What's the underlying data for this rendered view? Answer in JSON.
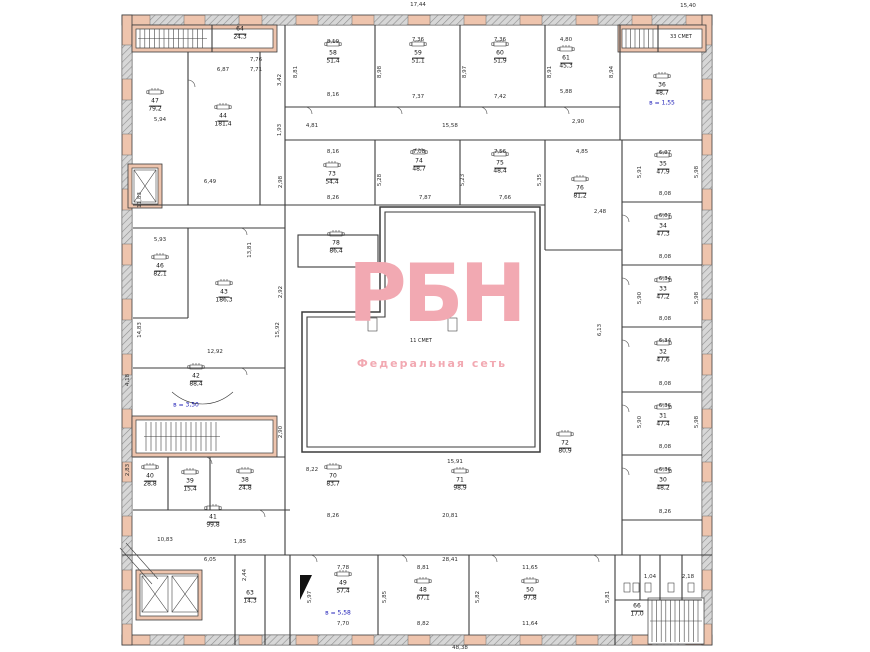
{
  "watermark": {
    "logo": "РБН",
    "tagline": "Федеральная сеть"
  },
  "colors": {
    "wall_fill": "#eec4ad",
    "window_fill": "#d7d7d7",
    "watermark_pink": "#f2a9b2",
    "blue_note": "#2222b8",
    "line": "#3b3b3b"
  },
  "rooms": [
    {
      "n": "64",
      "a": "24,3",
      "x": 240,
      "y": 34,
      "d": 0
    },
    {
      "n": "58",
      "a": "51,4",
      "x": 333,
      "y": 58,
      "d": 1
    },
    {
      "n": "59",
      "a": "51,1",
      "x": 418,
      "y": 58,
      "d": 1
    },
    {
      "n": "60",
      "a": "51,9",
      "x": 500,
      "y": 58,
      "d": 1
    },
    {
      "n": "61",
      "a": "45,3",
      "x": 566,
      "y": 63,
      "d": 1
    },
    {
      "n": "36",
      "a": "48,7",
      "x": 662,
      "y": 90,
      "d": 1
    },
    {
      "n": "47",
      "a": "79,2",
      "x": 155,
      "y": 106,
      "d": 1
    },
    {
      "n": "44",
      "a": "181,4",
      "x": 223,
      "y": 121,
      "d": 1
    },
    {
      "n": "73",
      "a": "54,4",
      "x": 332,
      "y": 179,
      "d": 1
    },
    {
      "n": "74",
      "a": "48,7",
      "x": 419,
      "y": 166,
      "d": 1
    },
    {
      "n": "75",
      "a": "48,4",
      "x": 500,
      "y": 168,
      "d": 1
    },
    {
      "n": "76",
      "a": "81,2",
      "x": 580,
      "y": 193,
      "d": 1
    },
    {
      "n": "78",
      "a": "86,4",
      "x": 336,
      "y": 248,
      "d": 1
    },
    {
      "n": "35",
      "a": "47,9",
      "x": 663,
      "y": 169,
      "d": 1
    },
    {
      "n": "34",
      "a": "47,3",
      "x": 663,
      "y": 231,
      "d": 1
    },
    {
      "n": "33",
      "a": "47,2",
      "x": 663,
      "y": 294,
      "d": 1
    },
    {
      "n": "32",
      "a": "47,6",
      "x": 663,
      "y": 357,
      "d": 1
    },
    {
      "n": "31",
      "a": "47,4",
      "x": 663,
      "y": 421,
      "d": 1
    },
    {
      "n": "30",
      "a": "48,2",
      "x": 663,
      "y": 485,
      "d": 1
    },
    {
      "n": "46",
      "a": "82,1",
      "x": 160,
      "y": 271,
      "d": 1
    },
    {
      "n": "43",
      "a": "186,3",
      "x": 224,
      "y": 297,
      "d": 1
    },
    {
      "n": "42",
      "a": "88,4",
      "x": 196,
      "y": 381,
      "d": 1
    },
    {
      "n": "40",
      "a": "28,8",
      "x": 150,
      "y": 481,
      "d": 1
    },
    {
      "n": "39",
      "a": "15,4",
      "x": 190,
      "y": 486,
      "d": 1
    },
    {
      "n": "38",
      "a": "24,8",
      "x": 245,
      "y": 485,
      "d": 1
    },
    {
      "n": "41",
      "a": "99,8",
      "x": 213,
      "y": 522,
      "d": 1
    },
    {
      "n": "70",
      "a": "83,7",
      "x": 333,
      "y": 481,
      "d": 1
    },
    {
      "n": "71",
      "a": "98,9",
      "x": 460,
      "y": 485,
      "d": 1
    },
    {
      "n": "72",
      "a": "80,9",
      "x": 565,
      "y": 448,
      "d": 1
    },
    {
      "n": "49",
      "a": "57,4",
      "x": 343,
      "y": 588,
      "d": 1
    },
    {
      "n": "48",
      "a": "67,1",
      "x": 423,
      "y": 595,
      "d": 1
    },
    {
      "n": "50",
      "a": "97,8",
      "x": 530,
      "y": 595,
      "d": 1
    },
    {
      "n": "66",
      "a": "17,0",
      "x": 637,
      "y": 611,
      "d": 0
    },
    {
      "n": "63",
      "a": "14,3",
      "x": 250,
      "y": 598,
      "d": 0
    }
  ],
  "notes_blue": [
    {
      "t": "в = 1,55",
      "x": 662,
      "y": 103
    },
    {
      "t": "в = 3,50",
      "x": 186,
      "y": 405
    },
    {
      "t": "в = 5,58",
      "x": 338,
      "y": 613
    }
  ],
  "labels_small": [
    {
      "t": "33 СМЕТ",
      "x": 681,
      "y": 37
    },
    {
      "t": "11 СМЕТ",
      "x": 421,
      "y": 341
    }
  ],
  "dims": [
    {
      "t": "17,44",
      "x": 418,
      "y": 5
    },
    {
      "t": "15,40",
      "x": 688,
      "y": 6
    },
    {
      "t": "8,19",
      "x": 333,
      "y": 42
    },
    {
      "t": "7,36",
      "x": 418,
      "y": 40
    },
    {
      "t": "7,36",
      "x": 500,
      "y": 40
    },
    {
      "t": "4,80",
      "x": 566,
      "y": 40
    },
    {
      "t": "8,16",
      "x": 333,
      "y": 95
    },
    {
      "t": "7,37",
      "x": 418,
      "y": 97
    },
    {
      "t": "7,42",
      "x": 500,
      "y": 97
    },
    {
      "t": "5,88",
      "x": 566,
      "y": 92
    },
    {
      "t": "8,81",
      "x": 296,
      "y": 72,
      "r": 1
    },
    {
      "t": "8,98",
      "x": 380,
      "y": 72,
      "r": 1
    },
    {
      "t": "8,97",
      "x": 465,
      "y": 72,
      "r": 1
    },
    {
      "t": "8,91",
      "x": 550,
      "y": 72,
      "r": 1
    },
    {
      "t": "8,94",
      "x": 612,
      "y": 72,
      "r": 1
    },
    {
      "t": "15,58",
      "x": 450,
      "y": 126
    },
    {
      "t": "4,81",
      "x": 312,
      "y": 126
    },
    {
      "t": "2,90",
      "x": 578,
      "y": 122
    },
    {
      "t": "8,16",
      "x": 333,
      "y": 152
    },
    {
      "t": "7,08",
      "x": 419,
      "y": 152
    },
    {
      "t": "7,56",
      "x": 500,
      "y": 152
    },
    {
      "t": "8,26",
      "x": 333,
      "y": 198
    },
    {
      "t": "7,87",
      "x": 425,
      "y": 198
    },
    {
      "t": "7,66",
      "x": 505,
      "y": 198
    },
    {
      "t": "5,28",
      "x": 380,
      "y": 180,
      "r": 1
    },
    {
      "t": "5,23",
      "x": 463,
      "y": 180,
      "r": 1
    },
    {
      "t": "5,35",
      "x": 540,
      "y": 180,
      "r": 1
    },
    {
      "t": "4,85",
      "x": 582,
      "y": 152
    },
    {
      "t": "2,48",
      "x": 600,
      "y": 212
    },
    {
      "t": "6,07",
      "x": 665,
      "y": 153
    },
    {
      "t": "8,08",
      "x": 665,
      "y": 194
    },
    {
      "t": "6,07",
      "x": 665,
      "y": 216
    },
    {
      "t": "8,08",
      "x": 665,
      "y": 257
    },
    {
      "t": "6,34",
      "x": 665,
      "y": 279
    },
    {
      "t": "8,08",
      "x": 665,
      "y": 319
    },
    {
      "t": "6,34",
      "x": 665,
      "y": 341
    },
    {
      "t": "8,08",
      "x": 665,
      "y": 384
    },
    {
      "t": "6,36",
      "x": 665,
      "y": 406
    },
    {
      "t": "8,08",
      "x": 665,
      "y": 447
    },
    {
      "t": "6,36",
      "x": 665,
      "y": 470
    },
    {
      "t": "8,26",
      "x": 665,
      "y": 512
    },
    {
      "t": "5,91",
      "x": 640,
      "y": 172,
      "r": 1
    },
    {
      "t": "5,98",
      "x": 697,
      "y": 172,
      "r": 1
    },
    {
      "t": "5,90",
      "x": 640,
      "y": 298,
      "r": 1
    },
    {
      "t": "5,98",
      "x": 697,
      "y": 298,
      "r": 1
    },
    {
      "t": "5,90",
      "x": 640,
      "y": 422,
      "r": 1
    },
    {
      "t": "5,98",
      "x": 697,
      "y": 422,
      "r": 1
    },
    {
      "t": "6,87",
      "x": 223,
      "y": 70
    },
    {
      "t": "5,94",
      "x": 160,
      "y": 120
    },
    {
      "t": "6,49",
      "x": 210,
      "y": 182
    },
    {
      "t": "11,83",
      "x": 140,
      "y": 200,
      "r": 1
    },
    {
      "t": "14,83",
      "x": 140,
      "y": 330,
      "r": 1
    },
    {
      "t": "13,81",
      "x": 250,
      "y": 250,
      "r": 1
    },
    {
      "t": "15,92",
      "x": 278,
      "y": 330,
      "r": 1
    },
    {
      "t": "2,98",
      "x": 281,
      "y": 182,
      "r": 1
    },
    {
      "t": "2,92",
      "x": 281,
      "y": 292,
      "r": 1
    },
    {
      "t": "2,90",
      "x": 281,
      "y": 432,
      "r": 1
    },
    {
      "t": "5,93",
      "x": 160,
      "y": 240
    },
    {
      "t": "12,92",
      "x": 215,
      "y": 352
    },
    {
      "t": "10,83",
      "x": 165,
      "y": 540
    },
    {
      "t": "1,85",
      "x": 240,
      "y": 542
    },
    {
      "t": "6,05",
      "x": 210,
      "y": 560
    },
    {
      "t": "6,13",
      "x": 600,
      "y": 330,
      "r": 1
    },
    {
      "t": "8,22",
      "x": 312,
      "y": 470
    },
    {
      "t": "8,26",
      "x": 333,
      "y": 516
    },
    {
      "t": "15,91",
      "x": 455,
      "y": 462
    },
    {
      "t": "20,81",
      "x": 450,
      "y": 516
    },
    {
      "t": "28,41",
      "x": 450,
      "y": 560
    },
    {
      "t": "48,38",
      "x": 460,
      "y": 648
    },
    {
      "t": "7,78",
      "x": 343,
      "y": 568
    },
    {
      "t": "8,81",
      "x": 423,
      "y": 568
    },
    {
      "t": "11,65",
      "x": 530,
      "y": 568
    },
    {
      "t": "7,70",
      "x": 343,
      "y": 624
    },
    {
      "t": "8,82",
      "x": 423,
      "y": 624
    },
    {
      "t": "11,64",
      "x": 530,
      "y": 624
    },
    {
      "t": "5,97",
      "x": 310,
      "y": 597,
      "r": 1
    },
    {
      "t": "5,85",
      "x": 385,
      "y": 597,
      "r": 1
    },
    {
      "t": "5,82",
      "x": 478,
      "y": 597,
      "r": 1
    },
    {
      "t": "5,81",
      "x": 608,
      "y": 597,
      "r": 1
    },
    {
      "t": "1,04",
      "x": 650,
      "y": 577
    },
    {
      "t": "2,18",
      "x": 688,
      "y": 577
    },
    {
      "t": "2,44",
      "x": 245,
      "y": 575,
      "r": 1
    },
    {
      "t": "4,18",
      "x": 128,
      "y": 380,
      "r": 1
    },
    {
      "t": "2,83",
      "x": 128,
      "y": 470,
      "r": 1
    },
    {
      "t": "3,42",
      "x": 280,
      "y": 80,
      "r": 1
    },
    {
      "t": "1,93",
      "x": 280,
      "y": 130,
      "r": 1
    },
    {
      "t": "7,76",
      "x": 256,
      "y": 60
    },
    {
      "t": "7,71",
      "x": 256,
      "y": 70
    }
  ]
}
